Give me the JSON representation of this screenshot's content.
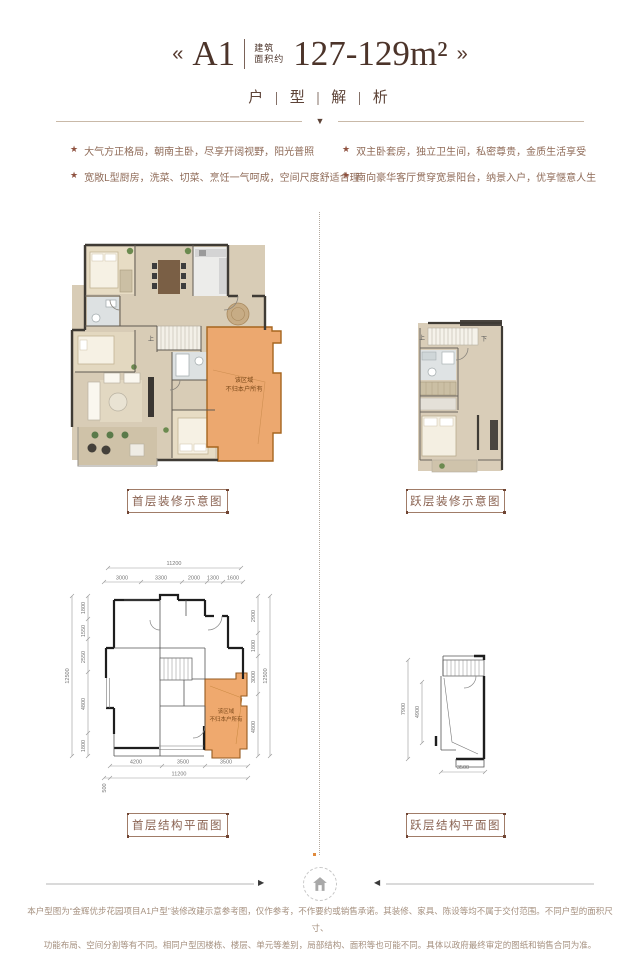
{
  "header": {
    "arrow_left": "«",
    "arrow_right": "»",
    "plan_code": "A1",
    "area_label_line1": "建筑",
    "area_label_line2": "面积约",
    "area_value": "127-129m²",
    "subtitle": "户 | 型 | 解 | 析",
    "divider_triangle": "▼"
  },
  "features": {
    "bullet": "★",
    "items": [
      "大气方正格局，朝南主卧，尽享开阔视野，阳光普照",
      "双主卧套房，独立卫生间，私密尊贵，金质生活享受",
      "宽敞L型厨房，洗菜、切菜、烹饪一气呵成，空间尺度舒适合理",
      "南向豪华客厅贯穿宽景阳台，纳景入户，优享惬意人生"
    ]
  },
  "deco_first": {
    "caption": "首层装修示意图",
    "stair_up": "上",
    "area_line1": "该区域",
    "area_line2": "不归本户所有"
  },
  "deco_loft": {
    "caption": "跃层装修示意图",
    "stair_up": "上",
    "stair_down": "下"
  },
  "struct_first": {
    "caption": "首层结构平面图",
    "area_line1": "该区域",
    "area_line2": "不归本户所有",
    "top_total": "11200",
    "top": [
      "3000",
      "3300",
      "2000",
      "1300",
      "1600"
    ],
    "left_total": "12500",
    "left": [
      "1800",
      "1550",
      "2550",
      "4800",
      "1800"
    ],
    "right": [
      "2900",
      "1800",
      "3000",
      "4800"
    ],
    "right_total": "12500",
    "bottom": [
      "4200",
      "3500",
      "3500"
    ],
    "bottom_offset": "500",
    "bottom_total": "11200"
  },
  "struct_loft": {
    "caption": "跃层结构平面图",
    "left_total": "7900",
    "left_inner": "4900",
    "bottom": "3500"
  },
  "footer": {
    "line1": "本户型图为“金辉优步花园项目A1户型”装修改建示意参考图，仅作参考，不作要约或销售承诺。其装修、家具、陈设等均不属于交付范围。不同户型的面积尺寸、",
    "line2": "功能布局、空间分割等有不同。相同户型因楼栋、楼层、单元等差别，局部结构、面积等也可能不同。具体以政府最终审定的图纸和销售合同为准。"
  },
  "colors": {
    "accent_brown": "#8a6352",
    "title_brown": "#4c342a",
    "orange_zone": "#eda871",
    "orange_zone_border": "#a6651f",
    "wall_dark": "#3f3b35"
  }
}
